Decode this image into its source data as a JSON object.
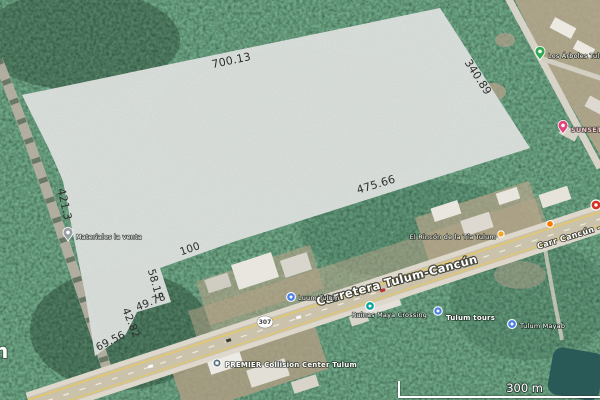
{
  "map": {
    "scale_bar": {
      "label": "300 m"
    },
    "road": {
      "main_label": "Carretera Tulum-Cancún",
      "right_label": "Carr Cancún - Tulum",
      "shield_number": "307"
    },
    "edge_label_fragment": "n",
    "parcel": {
      "fill_color": "#c7ccc8",
      "dimensions": [
        "700.13",
        "340.89",
        "475.66",
        "421.3",
        "100",
        "58.15",
        "49.78",
        "42.82",
        "69.56"
      ]
    },
    "places": [
      {
        "name": "Los Árboles Tulum",
        "marker": "green-pin"
      },
      {
        "name": "SUNSET BUNGALOWS",
        "marker": "pink-pin"
      },
      {
        "name": "Materiales la venta",
        "marker": "gray-pin"
      },
      {
        "name": "Luum Tulum",
        "marker": "blue-dot"
      },
      {
        "name": "Ruinas Maya Crossing",
        "marker": "teal-dot"
      },
      {
        "name": "Tulum tours",
        "marker": "blue-dot"
      },
      {
        "name": "El Rincón de la Tía Tulum",
        "marker": "yellow-dot"
      },
      {
        "name": "Tulum Mayab",
        "marker": "blue-dot"
      },
      {
        "name": "PREMIER Collision Center Tulum",
        "marker": "store-icon"
      }
    ],
    "marker_colors": {
      "green_pin": "#34a853",
      "pink_pin": "#e0457b",
      "gray_pin": "#9aa0a6",
      "blue_dot": "#4a80e4",
      "teal_dot": "#00a3a0",
      "yellow_dot": "#f5a623",
      "orange_pin": "#f57c00",
      "red_circle": "#d93025",
      "store_icon": "#546e7a"
    }
  }
}
